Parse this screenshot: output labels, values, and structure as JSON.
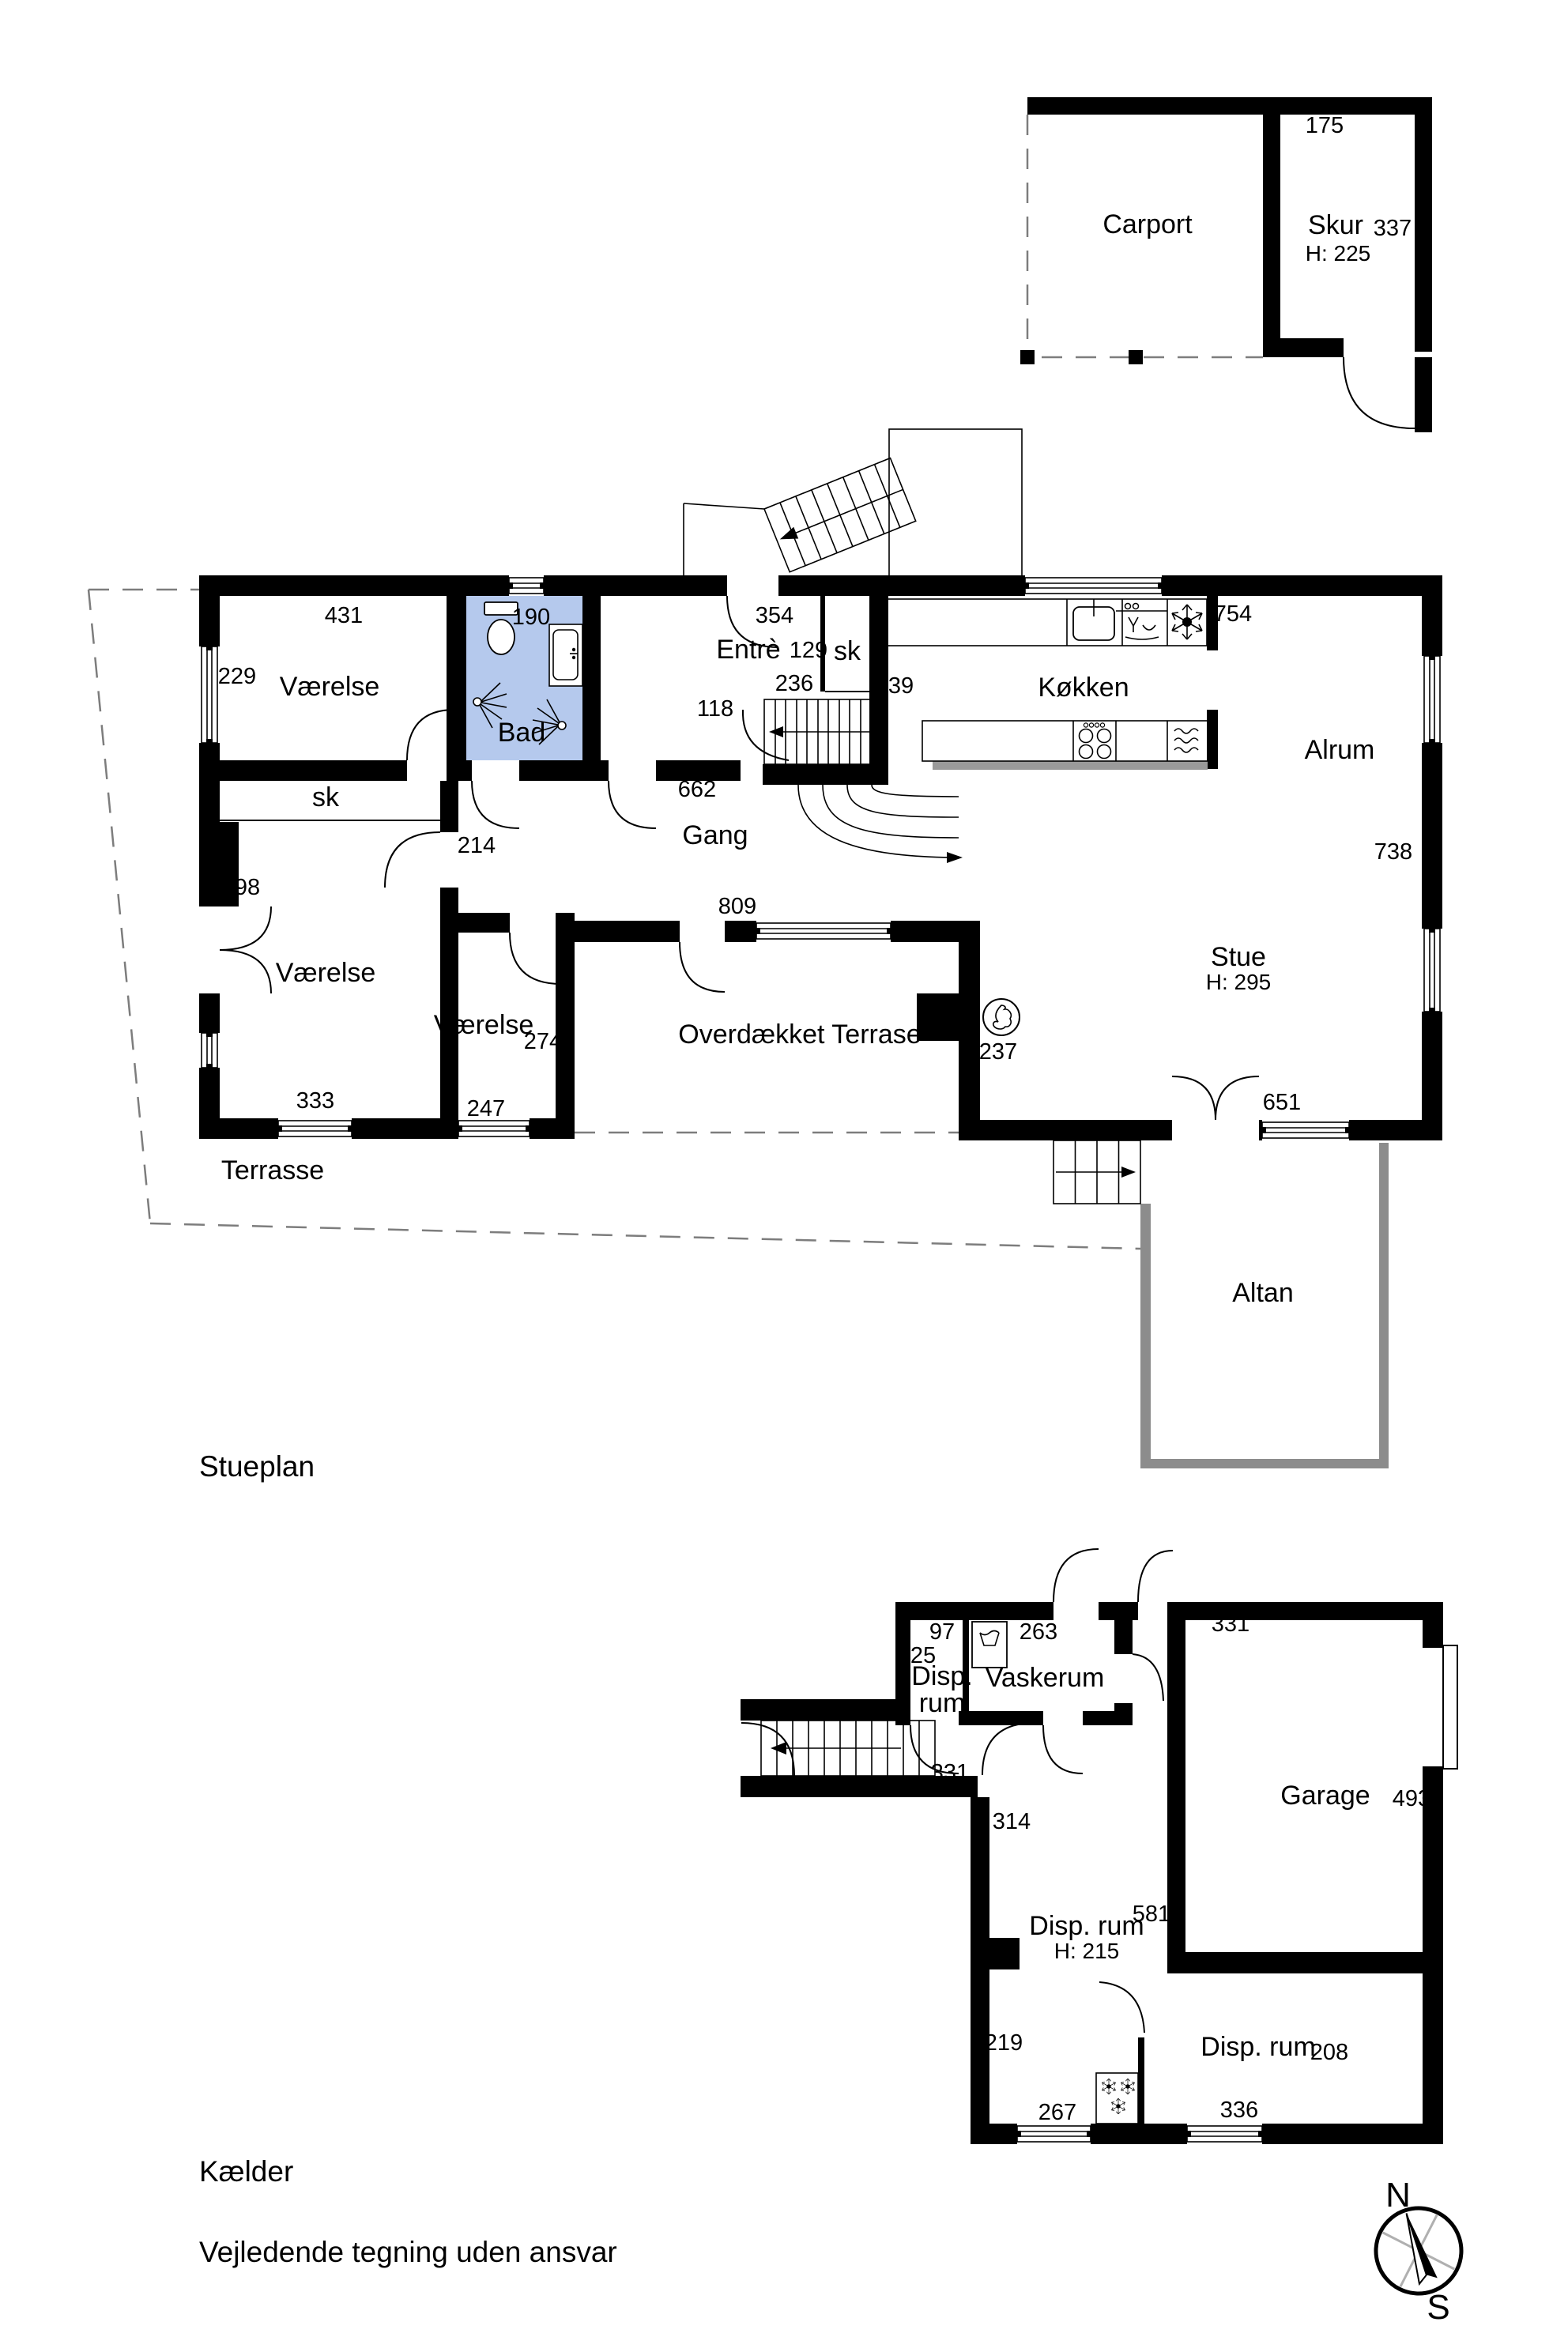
{
  "plan": {
    "title": "Stueplan",
    "rooms": {
      "carport": "Carport",
      "skur": "Skur",
      "skur_area": "337",
      "skur_height": "H: 225",
      "vaerelse_nw": "Værelse",
      "bad": "Bad",
      "entre": "Entrè",
      "sk_entre": "sk",
      "koekken": "Køkken",
      "alrum": "Alrum",
      "gang": "Gang",
      "sk_west": "sk",
      "vaerelse_sw": "Værelse",
      "vaerelse_s": "Værelse",
      "stue": "Stue",
      "stue_height": "H: 295",
      "overdaekket_terrasse": "Overdækket Terrase",
      "terrasse": "Terrasse",
      "altan": "Altan"
    },
    "dims": {
      "d175": "175",
      "d431": "431",
      "d229": "229",
      "d190": "190",
      "d354": "354",
      "d129": "129",
      "d754": "754",
      "d236": "236",
      "d239": "239",
      "d118": "118",
      "d662": "662",
      "d214": "214",
      "d498": "498",
      "d809": "809",
      "d738": "738",
      "d274": "274",
      "d333": "333",
      "d247": "247",
      "d237": "237",
      "d651": "651"
    }
  },
  "basement": {
    "title": "Kælder",
    "rooms": {
      "disp_nw_line1": "Disp.",
      "disp_nw_line2": "rum",
      "vaskerum": "Vaskerum",
      "garage": "Garage",
      "disp_mid": "Disp. rum",
      "disp_mid_height": "H: 215",
      "disp_se": "Disp. rum"
    },
    "dims": {
      "d97": "97",
      "d125": "125",
      "d263": "263",
      "d331_hall": "331",
      "d331_garage": "331",
      "d314": "314",
      "d581": "581",
      "d493": "493",
      "d219": "219",
      "d267": "267",
      "d336": "336",
      "d208": "208"
    }
  },
  "footer": {
    "disclaimer": "Vejledende tegning uden ansvar"
  },
  "compass": {
    "north": "N",
    "south": "S"
  },
  "colors": {
    "wall": "#000000",
    "bad_room_fill": "#b5c9ed",
    "outdoor_wall_gray": "#8c8c8c",
    "floor_strip_gray": "#9a9a9a",
    "dashed_line": "#7d7d7d"
  },
  "icons": [
    "toilet-icon",
    "sink-icon",
    "shower-icon",
    "kitchen-sink-icon",
    "dishwasher-icon",
    "fridge-snowflake-icon",
    "hob-icon",
    "oven-icon",
    "fireplace-icon",
    "washing-machine-icon",
    "freezer-snowflake-icon",
    "compass-icon"
  ]
}
